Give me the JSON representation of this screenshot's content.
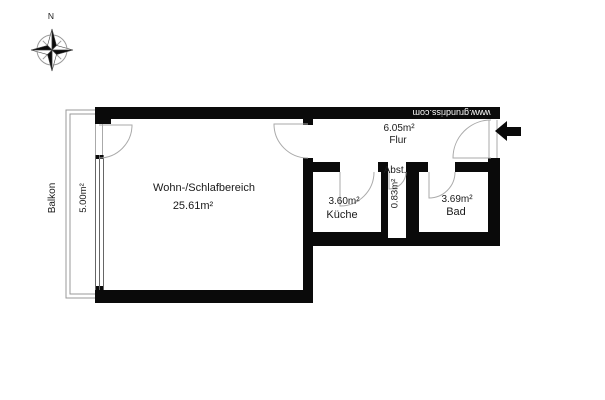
{
  "compass": {
    "north_label": "N"
  },
  "watermark": {
    "text": "www.grundriss.com"
  },
  "rooms": {
    "living": {
      "name": "Wohn-/Schlafbereich",
      "area": "25.61m²"
    },
    "flur": {
      "name": "Flur",
      "area": "6.05m²"
    },
    "kueche": {
      "name": "Küche",
      "area": "3.60m²"
    },
    "abst": {
      "name": "Abst.",
      "area": "0.83m²"
    },
    "bad": {
      "name": "Bad",
      "area": "3.69m²"
    },
    "balkon": {
      "name": "Balkon",
      "area": "5.00m²"
    }
  },
  "colors": {
    "wall": "#0a0a0a",
    "background": "#ffffff",
    "thin_line": "#999999",
    "window_line": "#666666",
    "door_line": "#aaaaaa",
    "watermark_text": "#ffffff"
  }
}
